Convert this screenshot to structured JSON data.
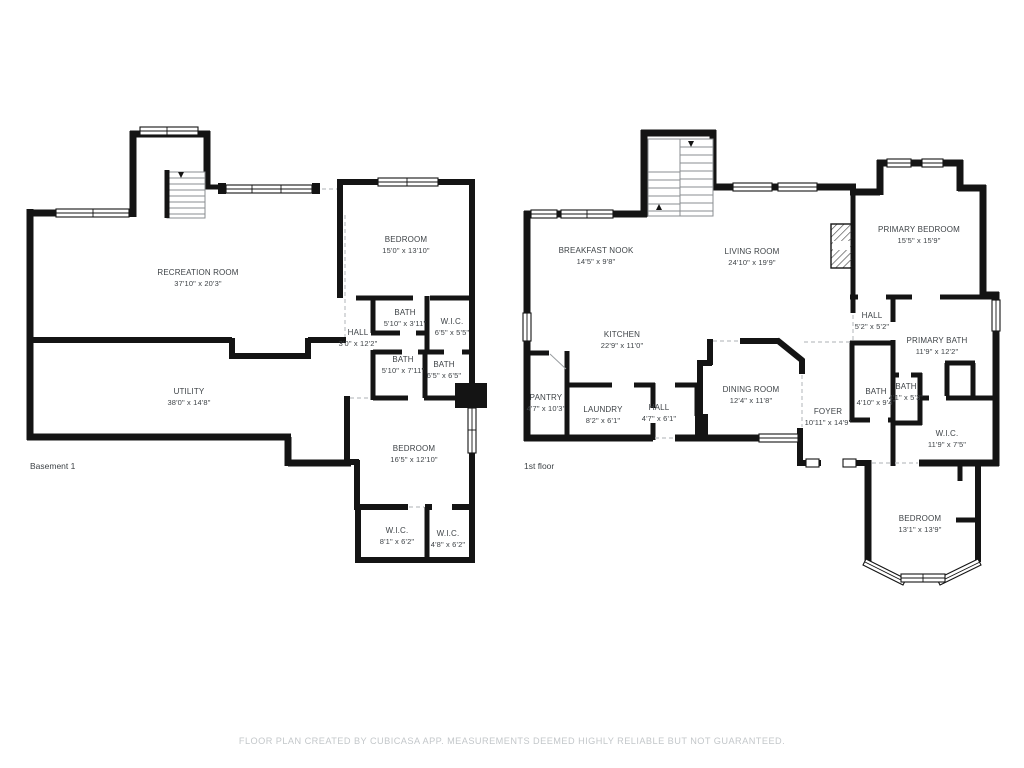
{
  "footer": {
    "disclaimer": "FLOOR PLAN CREATED BY CUBICASA APP. MEASUREMENTS DEEMED HIGHLY RELIABLE BUT NOT GUARANTEED."
  },
  "colors": {
    "wall": "#141414",
    "label_text": "#3e4347",
    "footer_text": "#c3c7ca",
    "background": "#ffffff"
  },
  "floors": [
    {
      "caption": "Basement 1",
      "caption_x": 30,
      "caption_y": 466,
      "rooms": [
        {
          "name": "RECREATION ROOM",
          "dims": "37'10\" x 20'3\"",
          "x": 198,
          "y": 278
        },
        {
          "name": "BEDROOM",
          "dims": "15'0\" x 13'10\"",
          "x": 406,
          "y": 245
        },
        {
          "name": "BATH",
          "dims": "5'10\" x 3'11\"",
          "x": 405,
          "y": 318
        },
        {
          "name": "W.I.C.",
          "dims": "6'5\" x 5'5\"",
          "x": 452,
          "y": 327
        },
        {
          "name": "HALL",
          "dims": "3'0\" x 12'2\"",
          "x": 358,
          "y": 338
        },
        {
          "name": "BATH",
          "dims": "5'10\" x 7'11\"",
          "x": 403,
          "y": 365
        },
        {
          "name": "BATH",
          "dims": "6'5\" x 6'5\"",
          "x": 444,
          "y": 370
        },
        {
          "name": "UTILITY",
          "dims": "38'0\" x 14'8\"",
          "x": 189,
          "y": 397
        },
        {
          "name": "BEDROOM",
          "dims": "16'5\" x 12'10\"",
          "x": 414,
          "y": 454
        },
        {
          "name": "W.I.C.",
          "dims": "8'1\" x 6'2\"",
          "x": 397,
          "y": 536
        },
        {
          "name": "W.I.C.",
          "dims": "4'8\" x 6'2\"",
          "x": 448,
          "y": 539
        }
      ]
    },
    {
      "caption": "1st floor",
      "caption_x": 524,
      "caption_y": 466,
      "rooms": [
        {
          "name": "BREAKFAST NOOK",
          "dims": "14'5\" x 9'8\"",
          "x": 596,
          "y": 256
        },
        {
          "name": "LIVING ROOM",
          "dims": "24'10\" x 19'9\"",
          "x": 752,
          "y": 257
        },
        {
          "name": "PRIMARY BEDROOM",
          "dims": "15'5\" x 15'9\"",
          "x": 919,
          "y": 235
        },
        {
          "name": "KITCHEN",
          "dims": "22'9\" x 11'0\"",
          "x": 622,
          "y": 340
        },
        {
          "name": "HALL",
          "dims": "5'2\" x 5'2\"",
          "x": 872,
          "y": 321
        },
        {
          "name": "PRIMARY BATH",
          "dims": "11'9\" x 12'2\"",
          "x": 937,
          "y": 346
        },
        {
          "name": "PANTRY",
          "dims": "4'7\" x 10'3\"",
          "x": 546,
          "y": 403
        },
        {
          "name": "LAUNDRY",
          "dims": "8'2\" x 6'1\"",
          "x": 603,
          "y": 415
        },
        {
          "name": "HALL",
          "dims": "4'7\" x 6'1\"",
          "x": 659,
          "y": 413
        },
        {
          "name": "DINING ROOM",
          "dims": "12'4\" x 11'8\"",
          "x": 751,
          "y": 395
        },
        {
          "name": "FOYER",
          "dims": "10'11\" x 14'9\"",
          "x": 828,
          "y": 417
        },
        {
          "name": "BATH",
          "dims": "4'10\" x 9'4\"",
          "x": 876,
          "y": 397
        },
        {
          "name": "BATH",
          "dims": "4'1\" x 5'3\"",
          "x": 906,
          "y": 392
        },
        {
          "name": "W.I.C.",
          "dims": "11'9\" x 7'5\"",
          "x": 947,
          "y": 439
        },
        {
          "name": "BEDROOM",
          "dims": "13'1\" x 13'9\"",
          "x": 920,
          "y": 524
        }
      ]
    }
  ]
}
